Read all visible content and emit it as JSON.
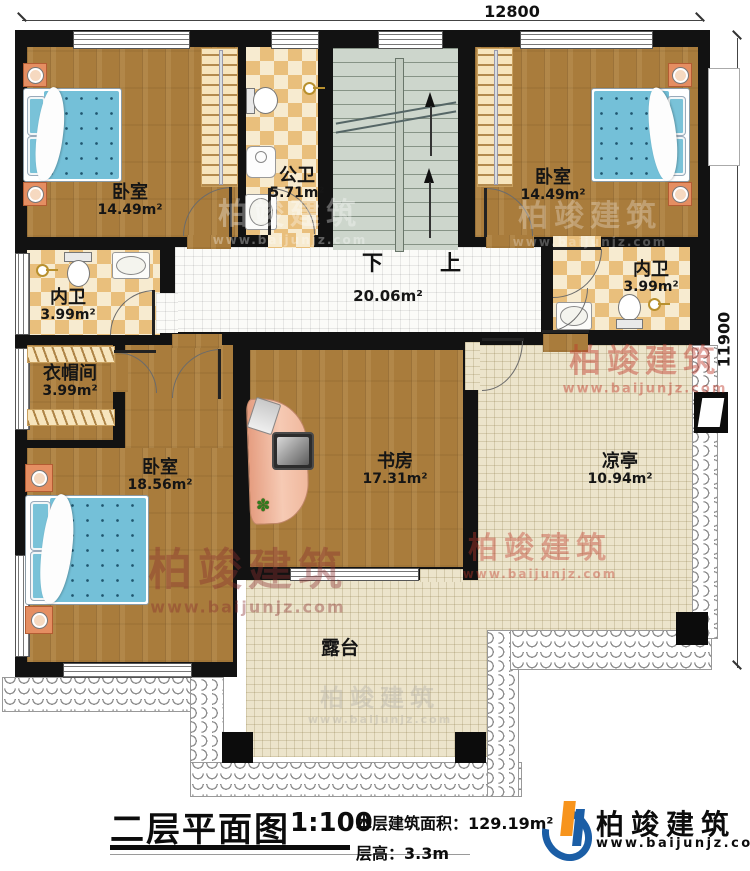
{
  "dimensions": {
    "width_top": "12800",
    "height_right": "11900"
  },
  "stairs": {
    "down": "下",
    "up": "上"
  },
  "rooms": {
    "bedroom_tl": {
      "name": "卧室",
      "area": "14.49m²"
    },
    "public_bath": {
      "name": "公卫",
      "area": "5.71m²"
    },
    "bedroom_tr": {
      "name": "卧室",
      "area": "14.49m²"
    },
    "bath_right": {
      "name": "内卫",
      "area": "3.99m²"
    },
    "bath_left": {
      "name": "内卫",
      "area": "3.99m²"
    },
    "cloakroom": {
      "name": "衣帽间",
      "area": "3.99m²"
    },
    "bedroom_bl": {
      "name": "卧室",
      "area": "18.56m²"
    },
    "study": {
      "name": "书房",
      "area": "17.31m²"
    },
    "pavilion": {
      "name": "凉亭",
      "area": "10.94m²"
    },
    "hall": {
      "area": "20.06m²"
    },
    "terrace": {
      "name": "露台"
    }
  },
  "title_block": {
    "title": "二层平面图",
    "scale": "1:100",
    "area_label": "本层建筑面积：",
    "area_value": "129.19m²",
    "floor_height_label": "层高：",
    "floor_height_value": "3.3m"
  },
  "brand": {
    "name": "柏竣建筑",
    "url": "www.baijunjz.com"
  },
  "colors": {
    "wall": "#121212",
    "wood": "#a97c3c",
    "tile": "#e9bf7c",
    "stair": "#cdd6cc",
    "terrace": "#ece4cb",
    "brand_blue": "#1b5ea6",
    "brand_orange": "#f7941d"
  }
}
